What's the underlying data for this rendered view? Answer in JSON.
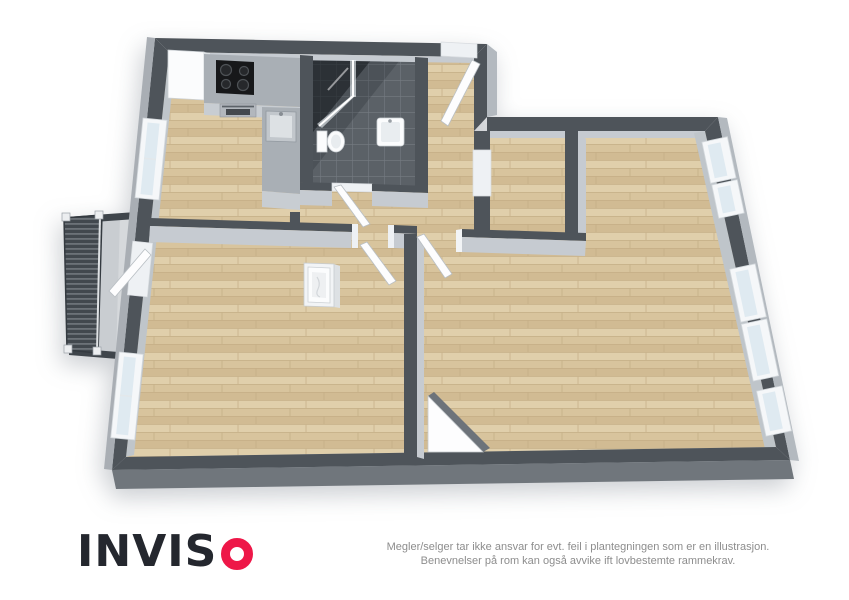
{
  "branding": {
    "logo_text": "INVISO",
    "logo_prefix": "INVIS",
    "logo_o_shape": "red-ring"
  },
  "disclaimer": {
    "line1": "Megler/selger tar ikke ansvar for evt. feil i plantegningen som er en illustrasjon.",
    "line2": "Benevnelser på rom kan også avvike ift lovbestemte rammekrav."
  },
  "colors": {
    "wall_dark": "#4e545a",
    "wall_face": "#c6cbd1",
    "wall_inner": "#bfc5ca",
    "wall_outer": "#a9aeb4",
    "wall_outer_lit": "#b3b9bf",
    "bottom_wall_face": "#70767c",
    "floor_wood_a": "#d8c49d",
    "floor_wood_b": "#d1bb93",
    "floor_wood_c": "#e0cfab",
    "wood_line": "#c3ad85",
    "tile": "#5b6167",
    "grout": "#757b82",
    "balcony_floor": "#c9cdd1",
    "railing_dark": "#42484e",
    "railing_line": "#878d93",
    "glass": "#dfeaf1",
    "frame_white": "#f5f7f9",
    "fixture_white": "#fbfcfd",
    "fixture_shade": "#dde1e4",
    "counter_top": "#a9afb5",
    "counter_face": "#c8cdd2",
    "cooktop_black": "#17181a",
    "oven_steel": "#b2b7bd",
    "door_white": "#fdfdfe",
    "door_edge": "#b9bfc4",
    "triangle_edge": "#6d737a",
    "logo_dark": "#24272e",
    "logo_red": "#ee1748",
    "text_muted": "#8d8d8d",
    "background": "#ffffff"
  },
  "floorplan": {
    "style": "3d-top-down-render",
    "floor_materials": [
      "wood-parquet",
      "dark-tile-bathroom",
      "concrete-balcony"
    ],
    "fixtures": [
      "tall-cabinet",
      "cooktop",
      "oven",
      "kitchen-counter",
      "kitchen-sink",
      "corner-shower",
      "toilet",
      "bathroom-sink",
      "white-floor-unit"
    ],
    "windows_count": 7,
    "door_leaves_count": 6,
    "has_balcony": true
  }
}
